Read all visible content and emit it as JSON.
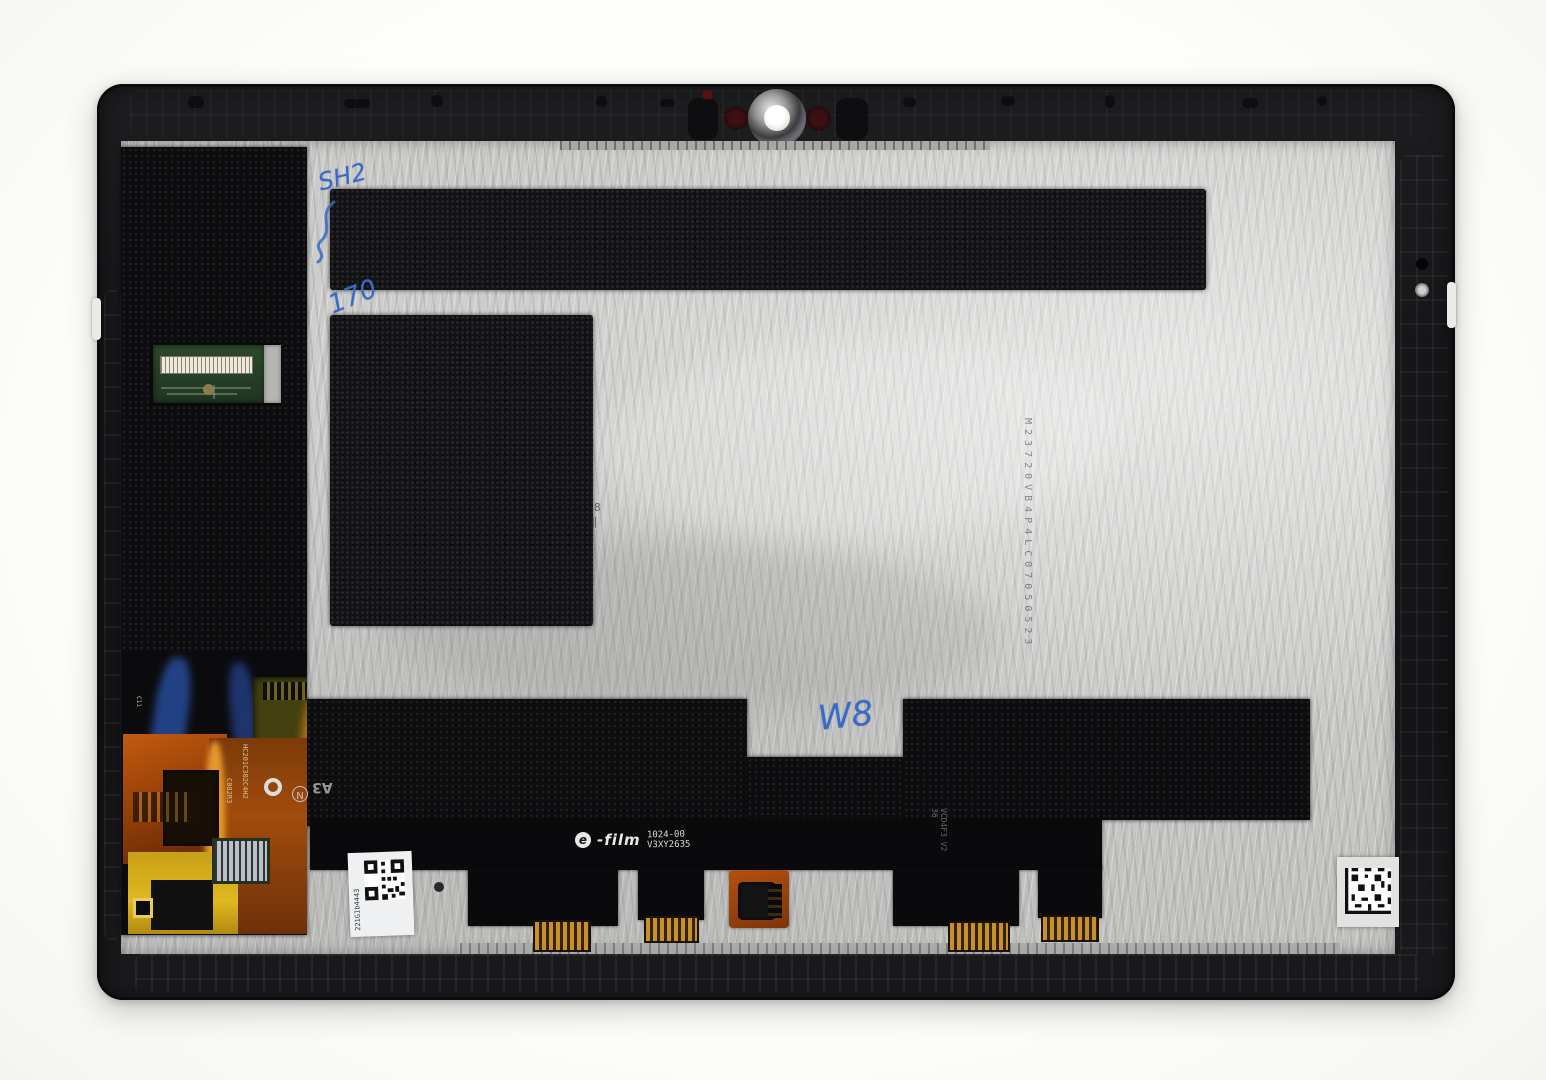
{
  "meta": {
    "description": "Rear-view photograph of a tablet LCD and touch screen display assembly spare part in a black plastic frame, lying on a white background"
  },
  "colors": {
    "background": "#fcfcfa",
    "frame_black": "#17171a",
    "panel_silver": "#c9c9c7",
    "tape_black": "#0d0d0f",
    "handwriting_blue": "#3a6bc4",
    "flex_orange": "#c95f10",
    "pcb_green": "#2d4a2c",
    "connector_gold": "#c89028"
  },
  "prints": {
    "efilm_logo_letter": "e",
    "efilm_brand": "-film",
    "efilm_part_line1": "1024-00",
    "efilm_part_line2": "V3XY2635",
    "serial_vertical": "M23720VB4P4LC07050523",
    "sticker_left_code": "221G1b4443",
    "ribbon_right_code": "VCD4F3 V2 36",
    "flex_code_1": "HC201C302C4H2",
    "flex_code_2": "C082R3",
    "flex_code_3": "C11",
    "flex_mark_a3": "A3",
    "flex_mark_n": "N",
    "panel_mark_8": "8",
    "panel_mark_bars": "‖"
  },
  "handwriting": {
    "mark_top": "SH2",
    "mark_left": "170",
    "mark_center": "W8"
  }
}
